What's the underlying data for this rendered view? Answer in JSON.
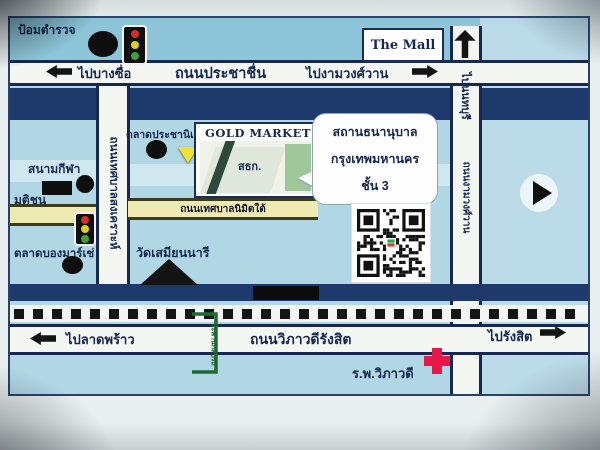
{
  "map": {
    "landmarks": {
      "police_box": "ป้อมตำรวจ",
      "the_mall": "The Mall",
      "market": "ตลาดประชานิเวศน์ 1",
      "gold_market": "GOLD MARKET",
      "building_sign": "สธก.",
      "stadium": "สนามกีฬา",
      "matichon": "มติชน",
      "bon_marche_market": "ตลาดบองมาร์เช่",
      "wat_samian_nari": "วัดเสมียนนารี",
      "hospital": "ร.พ.วิภาวดี"
    },
    "callout": {
      "line1": "สถานธนานุบาล",
      "line2": "กรุงเทพมหานคร",
      "line3": "ชั้น 3"
    },
    "roads": {
      "prachachuen": "ถนนประชาชื่น",
      "vibhavadi_rangsit": "ถนนวิภาวดีรังสิต",
      "thetsaban_songkhro": "ถนนเทศบาลสงเคราะห์",
      "thetsaban_nimit_tai": "ถนนเทศบาลนิมิตใต้",
      "ngamwongwan": "ถนนงามวงศ์วาน",
      "u_turn_bridge": "สะพานกลับรถ"
    },
    "directions": {
      "to_bang_sue": "ไปบางซื่อ",
      "to_ngamwongwan": "ไปงามวงศ์วาน",
      "to_nonthaburi": "ไปนนทบุรี",
      "to_lat_phrao": "ไปลาดพร้าว",
      "to_rangsit": "ไปรังสิต"
    },
    "colors": {
      "map_bg": "#b2d7e4",
      "top_strip": "#8cc6d8",
      "road_fill": "#f3f6f1",
      "road_border": "#16284f",
      "navy_band": "#1e3a6c",
      "text_navy": "#16284f",
      "yellow_road": "#efeab2",
      "marker_yellow": "#f0e232",
      "hospital_red": "#e8174a",
      "uturn_green": "#1d6a32",
      "traffic_red": "#d03028",
      "traffic_yellow": "#ddd020",
      "traffic_green": "#3f9f3f"
    }
  }
}
